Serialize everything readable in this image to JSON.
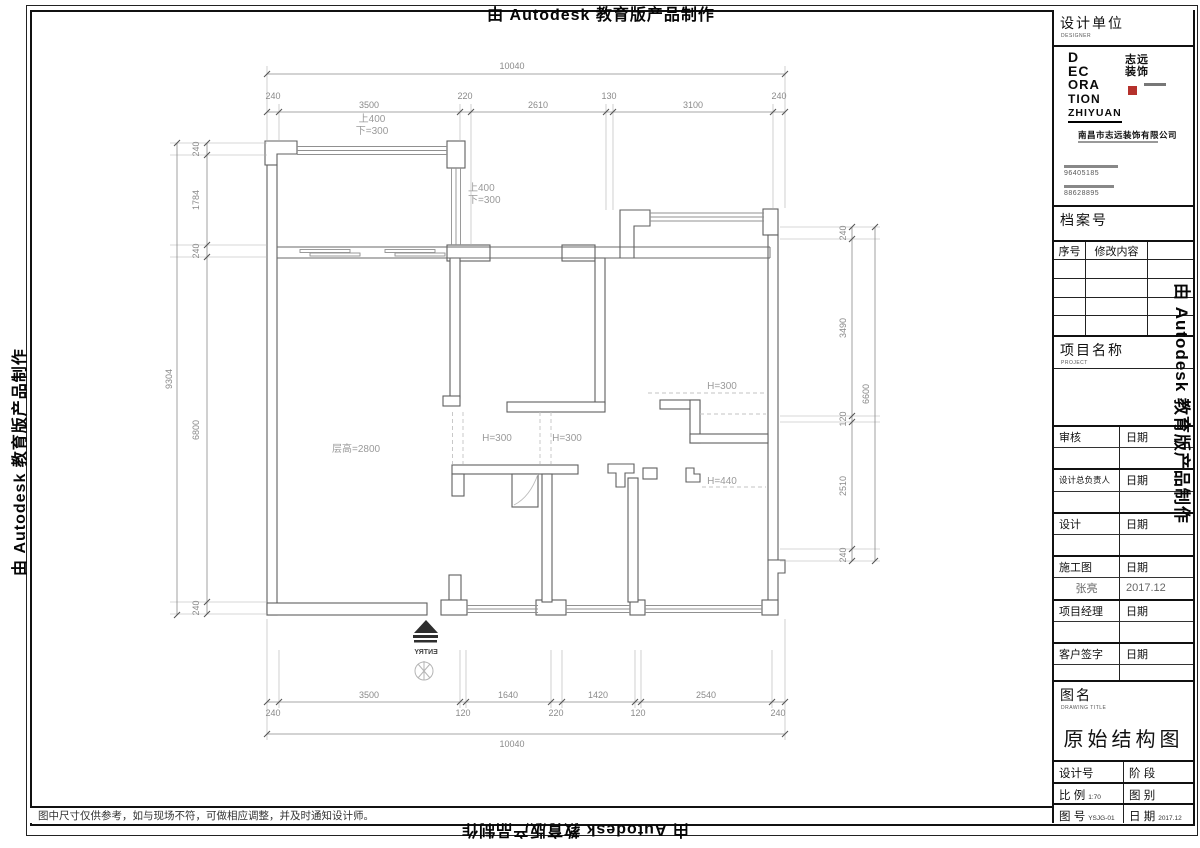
{
  "watermark": {
    "text": "由 Autodesk 教育版产品制作"
  },
  "disclaimer": "图中尺寸仅供参考，如与现场不符，可做相应调整，并及时通知设计师。",
  "colors": {
    "logo_red": "#b5312c",
    "wall": "#5f5f5f",
    "dim": "#8a8a8a"
  },
  "plan": {
    "labels": {
      "floor_height": "层高=2800",
      "h300_a": "H=300",
      "h300_b": "H=300",
      "h300_c": "H=300",
      "h440": "H=440",
      "beam1_up": "上400",
      "beam1_down": "下=300",
      "beam2_up": "上400",
      "beam2_down": "下=300",
      "entry": "ENTRY"
    },
    "dims": {
      "top": {
        "overall": "10040",
        "chain": [
          "240",
          "3500",
          "220",
          "2610",
          "130",
          "3100",
          "240"
        ]
      },
      "bottom": {
        "overall": "10040",
        "chain": [
          "240",
          "3500",
          "120",
          "1640",
          "220",
          "1420",
          "120",
          "2540",
          "240"
        ]
      },
      "left": {
        "overall": "9304",
        "chain": [
          "240",
          "1784",
          "240",
          "6800",
          "240"
        ]
      },
      "right": {
        "overall": "6600",
        "chain": [
          "240",
          "3490",
          "120",
          "2510",
          "240"
        ]
      }
    }
  },
  "title_block": {
    "designer": {
      "label": "设计单位",
      "sub": "DESIGNER"
    },
    "logo": {
      "stack": [
        "D",
        "EC",
        "ORA",
        "TION",
        "ZHIYUAN"
      ],
      "seal_top": "志远",
      "seal_bottom": "装饰",
      "company": "南昌市志远装饰有限公司",
      "phone1": "96405185",
      "phone2": "88628895"
    },
    "archive": {
      "label": "档案号"
    },
    "revision": {
      "col1": "序号",
      "col2": "修改内容"
    },
    "project": {
      "label": "项目名称",
      "sub": "PROJECT"
    },
    "sign_rows": [
      [
        "审核",
        "日期"
      ],
      [
        "",
        ""
      ],
      [
        "设计总负责人",
        "日期"
      ],
      [
        "",
        ""
      ],
      [
        "设计",
        "日期"
      ],
      [
        "",
        ""
      ],
      [
        "施工图",
        "日期"
      ],
      [
        "张亮",
        "2017.12"
      ],
      [
        "项目经理",
        "日期"
      ],
      [
        "",
        ""
      ],
      [
        "客户签字",
        "日期"
      ],
      [
        "",
        ""
      ]
    ],
    "drawing": {
      "label": "图名",
      "sub": "DRAWING TITLE",
      "title": "原始结构图"
    },
    "footer": {
      "design_no_label": "设计号",
      "stage_label": "阶 段",
      "scale_label": "比 例",
      "scale_value": "1:70",
      "category_label": "图 别",
      "number_label": "图 号",
      "number_value": "YSJG-01",
      "date_label": "日 期",
      "date_value": "2017.12"
    }
  }
}
